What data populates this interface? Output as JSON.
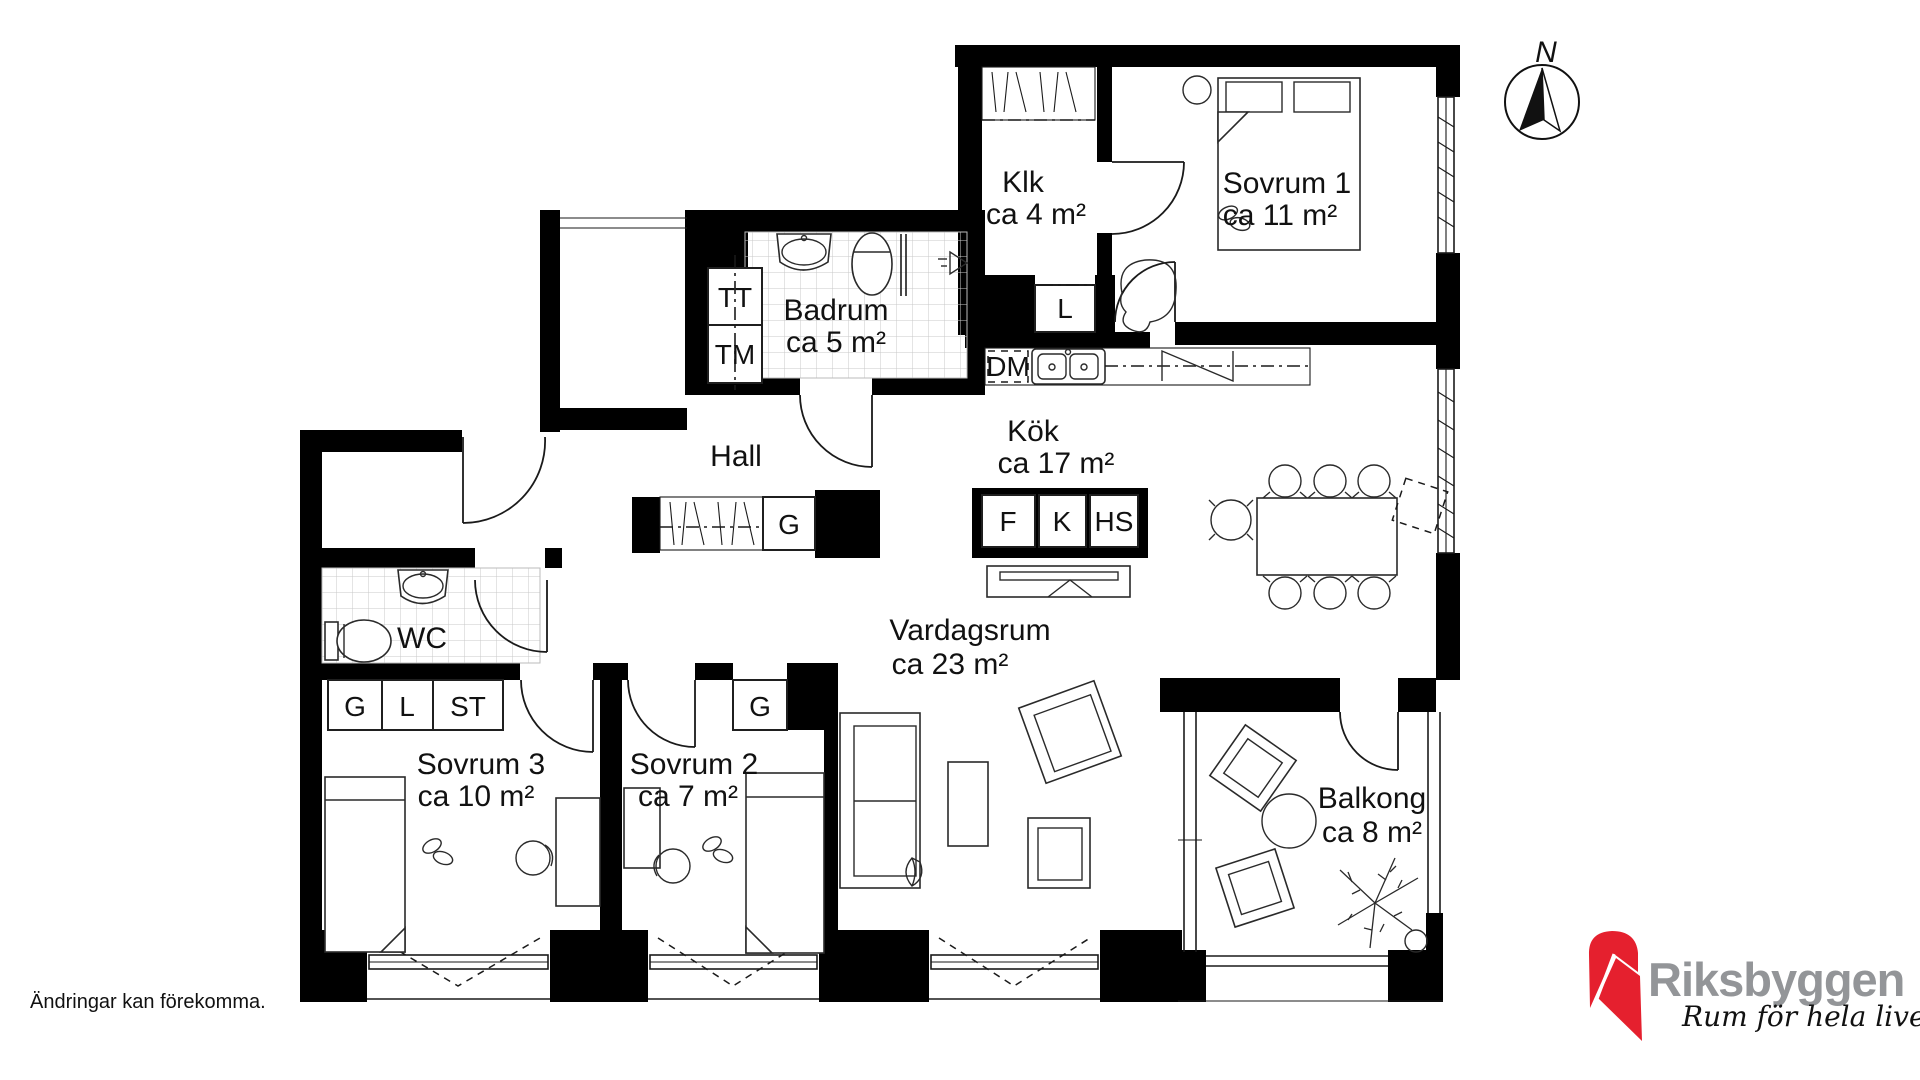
{
  "plan": {
    "compass_label": "N",
    "disclaimer": "Ändringar kan förekomma.",
    "brand": {
      "name": "Riksbyggen",
      "tagline": "Rum för hela livet",
      "red": "#e5202e",
      "gray": "#939598"
    },
    "rooms": {
      "klk": {
        "name": "Klk",
        "area": "ca 4 m²"
      },
      "sovrum1": {
        "name": "Sovrum 1",
        "area": "ca 11 m²"
      },
      "badrum": {
        "name": "Badrum",
        "area": "ca 5 m²"
      },
      "kok": {
        "name": "Kök",
        "area": "ca 17 m²"
      },
      "hall": {
        "name": "Hall"
      },
      "wc": {
        "name": "WC"
      },
      "sovrum3": {
        "name": "Sovrum 3",
        "area": "ca 10 m²"
      },
      "sovrum2": {
        "name": "Sovrum 2",
        "area": "ca 7 m²"
      },
      "vardagsrum": {
        "name": "Vardagsrum",
        "area": "ca 23 m²"
      },
      "balkong": {
        "name": "Balkong",
        "area": "ca 8 m²"
      }
    },
    "fixtures": {
      "tt": "TT",
      "tm": "TM",
      "dm": "DM",
      "l_klk": "L",
      "g_hall": "G",
      "f": "F",
      "k": "K",
      "hs": "HS",
      "g_sov3": "G",
      "l_sov3": "L",
      "st_sov3": "ST",
      "g_sov2": "G"
    }
  }
}
